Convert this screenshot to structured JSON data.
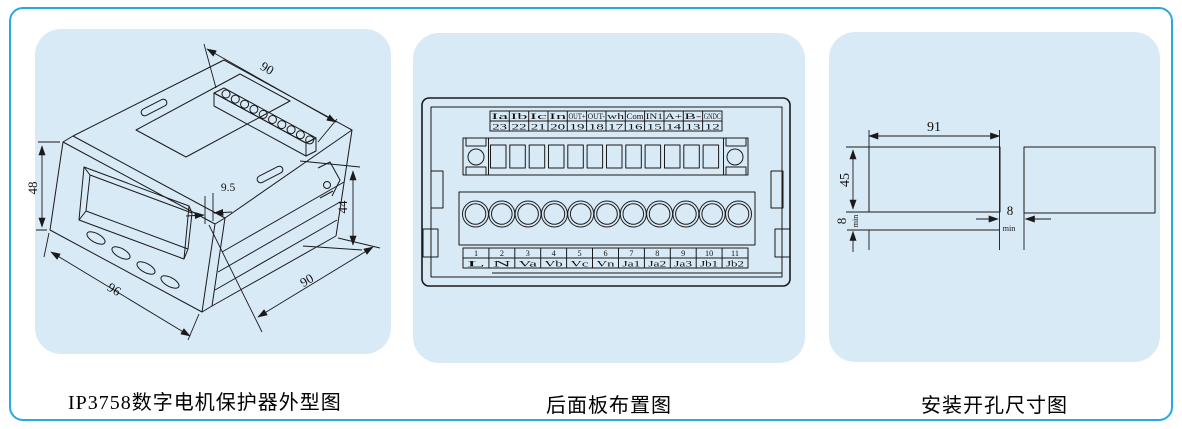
{
  "colors": {
    "border": "#29a9e1",
    "card_bg": "#d9eaf7",
    "line": "#1a1a1a",
    "text": "#000000"
  },
  "outline_panel": {
    "caption": "IP3758数字电机保护器外型图",
    "dims": {
      "top_depth": "90",
      "height": "48",
      "width": "96",
      "bezel_depth": "9.5",
      "body_height": "44",
      "body_depth": "90"
    }
  },
  "rear_panel": {
    "caption": "后面板布置图",
    "top_row": {
      "labels": [
        "Ia",
        "Ib",
        "Ic",
        "In",
        "OUT+",
        "OUT-",
        "wh",
        "Com",
        "IN1",
        "A+",
        "B-",
        "GNDC"
      ],
      "numbers": [
        "23",
        "22",
        "21",
        "20",
        "19",
        "18",
        "17",
        "16",
        "15",
        "14",
        "13",
        "12"
      ]
    },
    "bottom_row": {
      "numbers": [
        "1",
        "2",
        "3",
        "4",
        "5",
        "6",
        "7",
        "8",
        "9",
        "10",
        "11"
      ],
      "labels": [
        "L",
        "N",
        "Va",
        "Vb",
        "Vc",
        "Vn",
        "Ja1",
        "Ja2",
        "Ja3",
        "Jb1",
        "Jb2"
      ]
    }
  },
  "cutout_panel": {
    "caption": "安装开孔尺寸图",
    "dims": {
      "width": "91",
      "height": "45",
      "gap_v": "8",
      "gap_v_unit": "min",
      "gap_h": "8",
      "gap_h_unit": "min"
    }
  }
}
